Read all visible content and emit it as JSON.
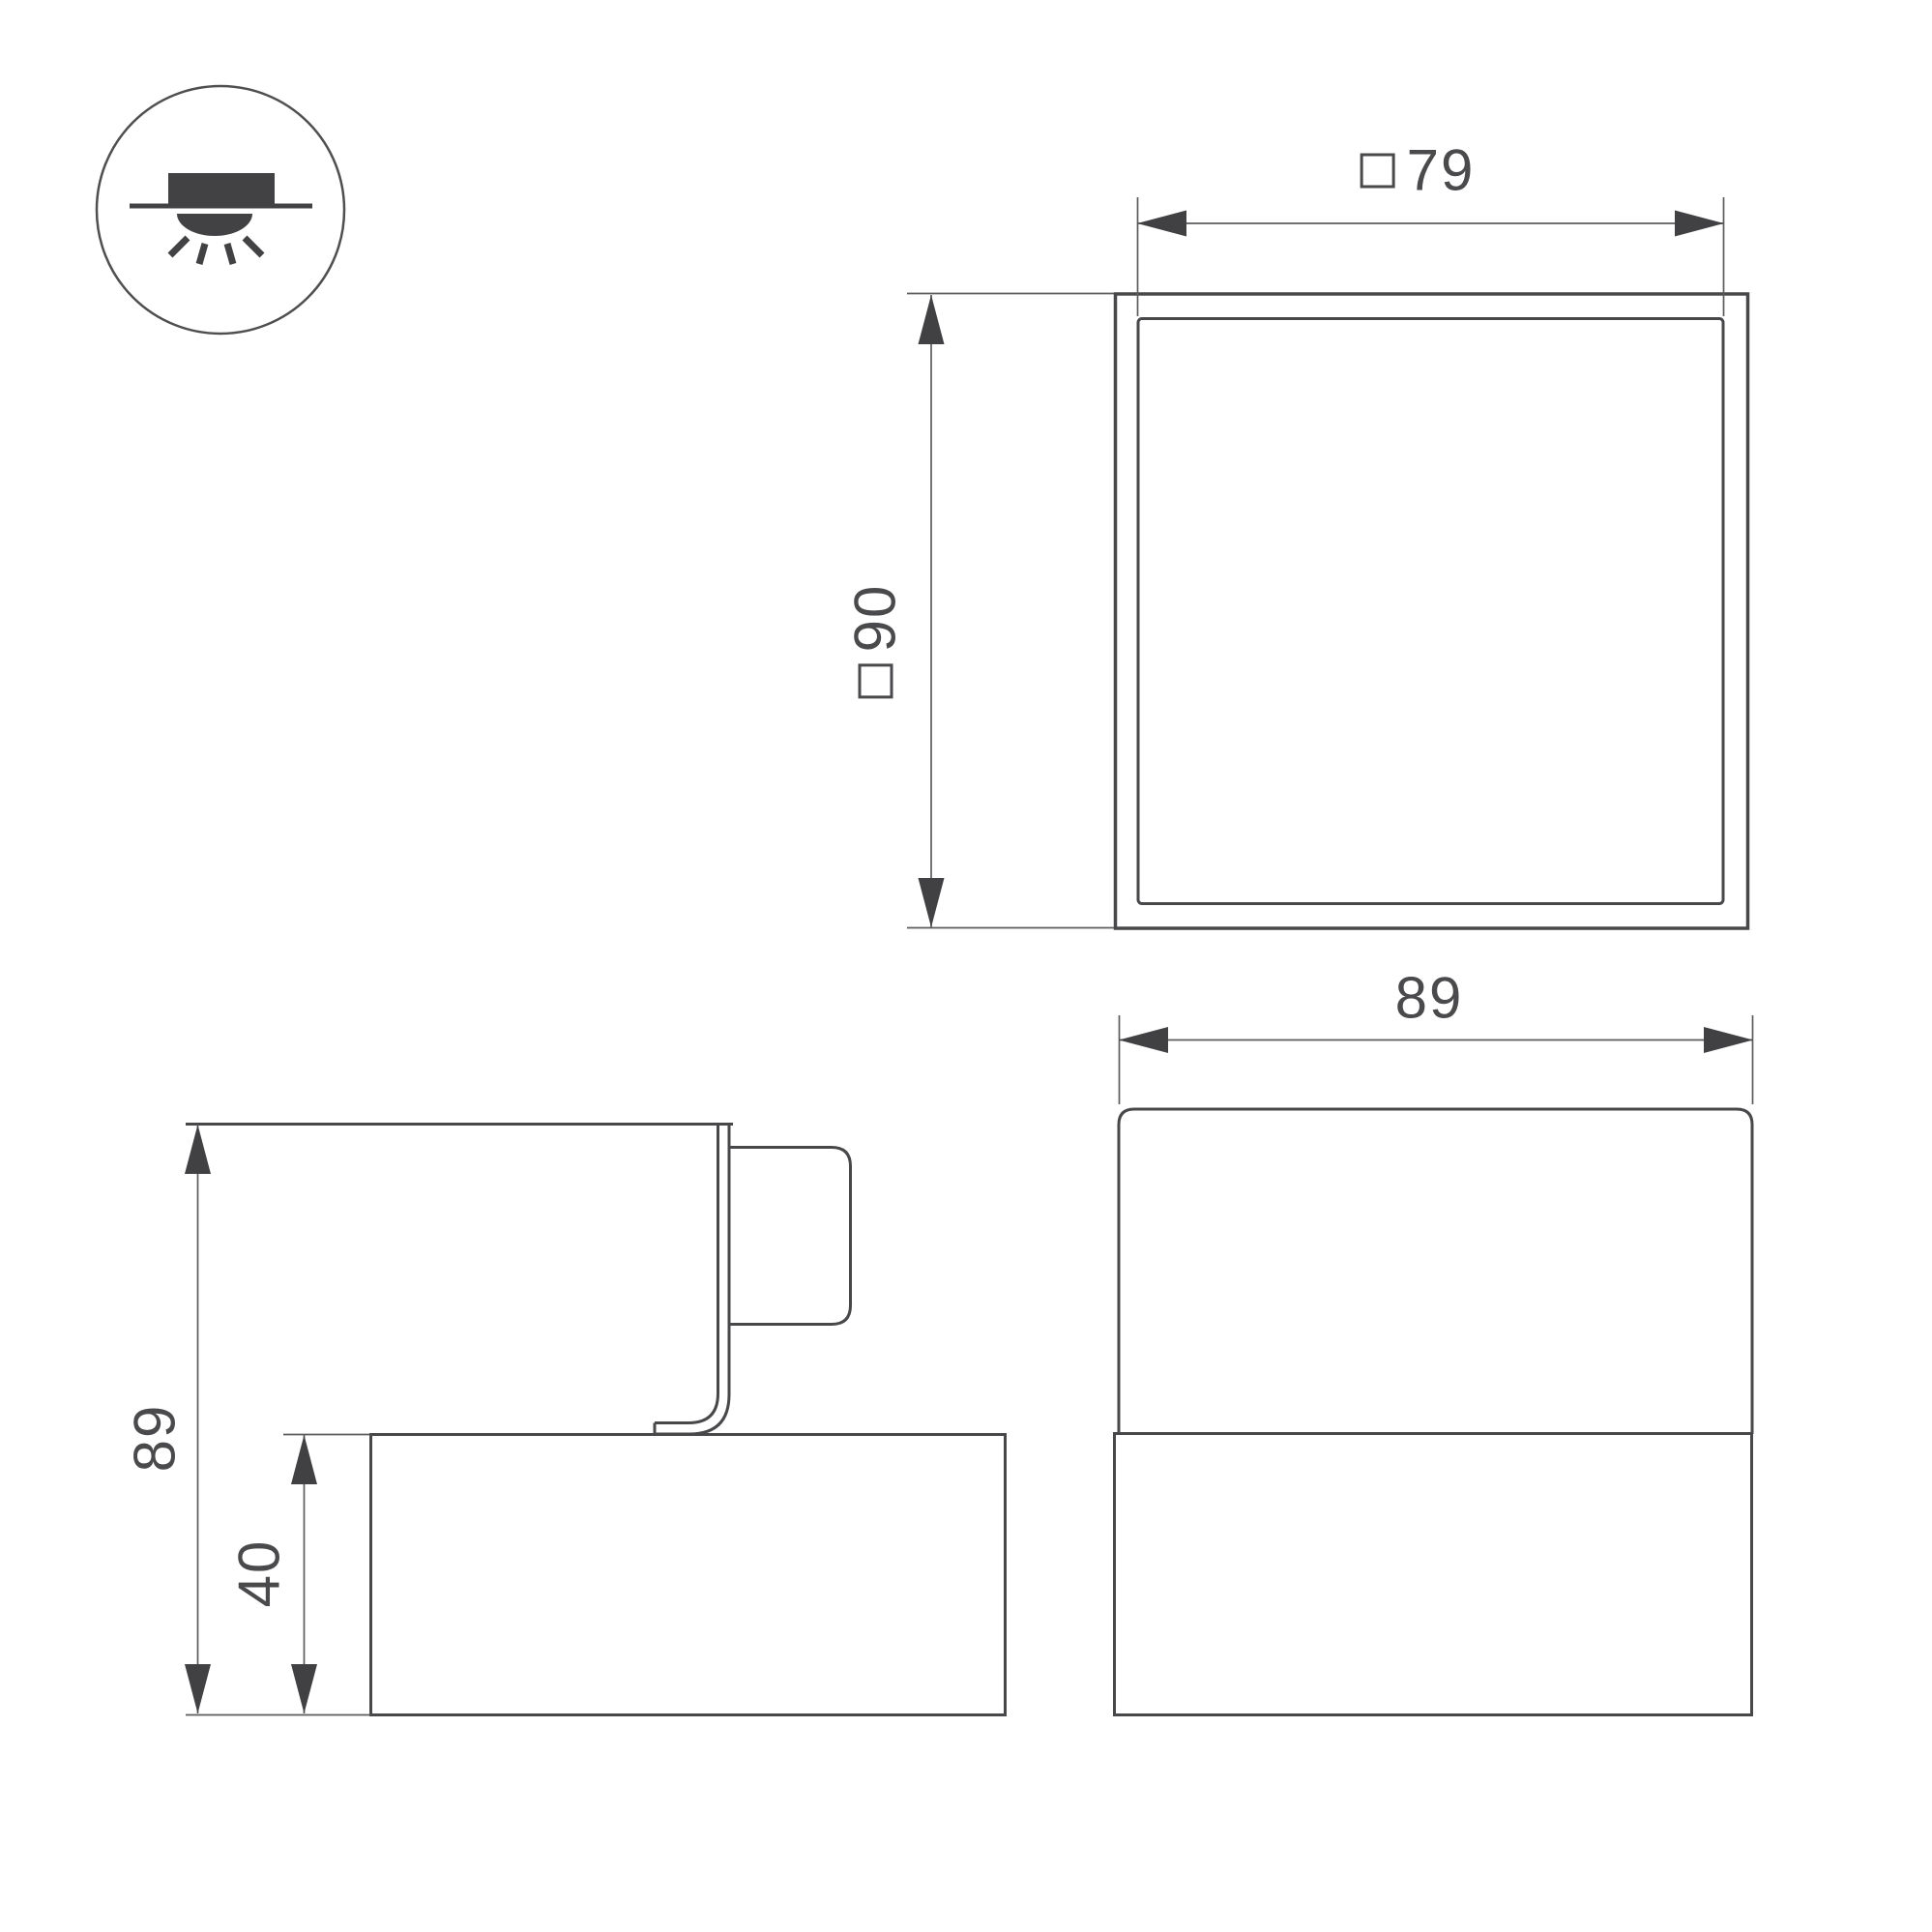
{
  "page": {
    "background": "#ffffff",
    "kind": "luminaire-dimension-drawing"
  },
  "colors": {
    "object_line": "#48484b",
    "dimension_line": "#5c5c5e",
    "arrow_fill": "#414144",
    "text": "#4a4a4d"
  },
  "mount_icon": {
    "name": "recessed-ceiling-light-icon"
  },
  "views": {
    "top": {
      "name": "top-view",
      "dim_width": {
        "square_symbol": "□",
        "value": "79"
      },
      "dim_height": {
        "square_symbol": "□",
        "value": "90"
      }
    },
    "side": {
      "name": "side-view",
      "dim_total_height": {
        "value": "89"
      },
      "dim_base_height": {
        "value": "40"
      }
    },
    "front": {
      "name": "front-view",
      "dim_width": {
        "value": "89"
      }
    }
  }
}
